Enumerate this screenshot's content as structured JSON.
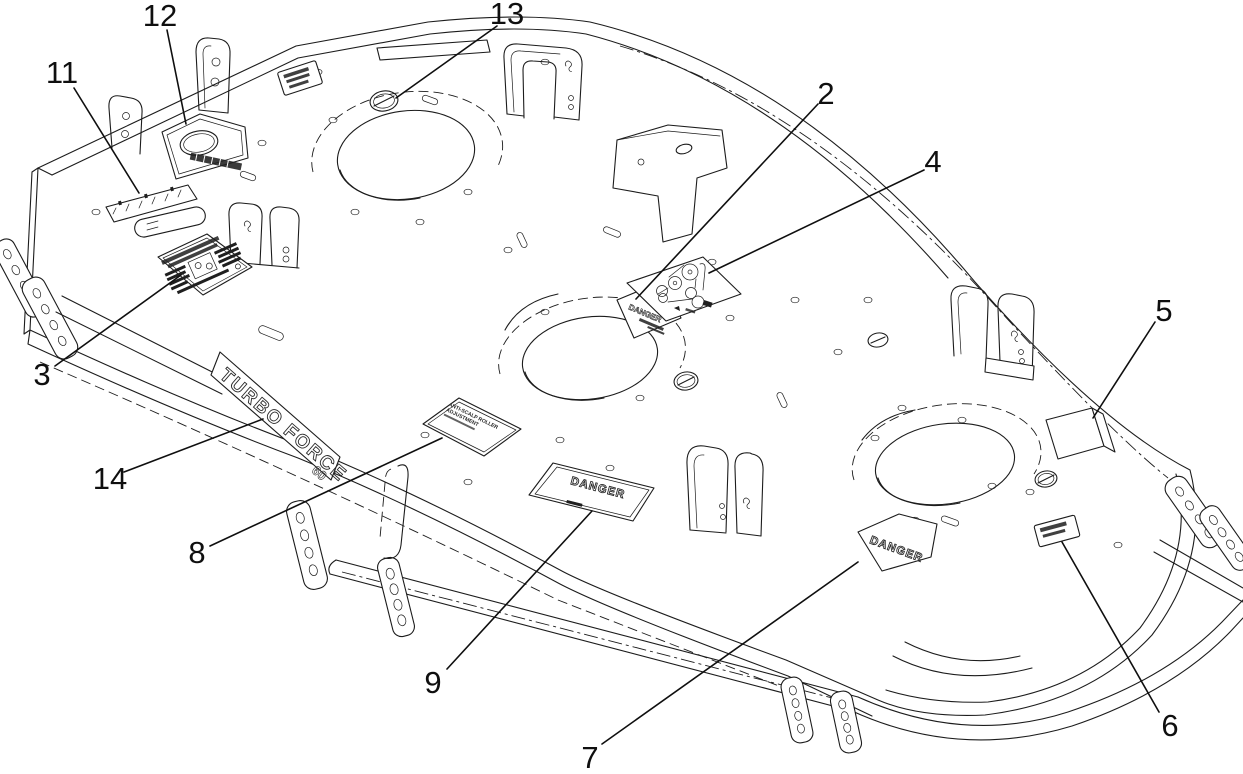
{
  "diagram": {
    "type": "exploded-parts-diagram",
    "subject": "Mower deck decal and plug locations",
    "background": "#ffffff",
    "line_color": "#1c1c1c",
    "decals": {
      "model_plate": {
        "line1": "TURBO FORCE",
        "line2": "60"
      },
      "danger_front": {
        "text": "DANGER"
      },
      "danger_pentagon": {
        "text": "DANGER"
      },
      "danger_small": {
        "text": "DANGER"
      },
      "anti_scalp": {
        "line1": "ANTI-SCALP ROLLER",
        "line2": "ADJUSTMENT"
      }
    },
    "callouts": [
      {
        "label": "2"
      },
      {
        "label": "3"
      },
      {
        "label": "4"
      },
      {
        "label": "5"
      },
      {
        "label": "6"
      },
      {
        "label": "7"
      },
      {
        "label": "8"
      },
      {
        "label": "9"
      },
      {
        "label": "11"
      },
      {
        "label": "12"
      },
      {
        "label": "13"
      },
      {
        "label": "14"
      }
    ]
  }
}
